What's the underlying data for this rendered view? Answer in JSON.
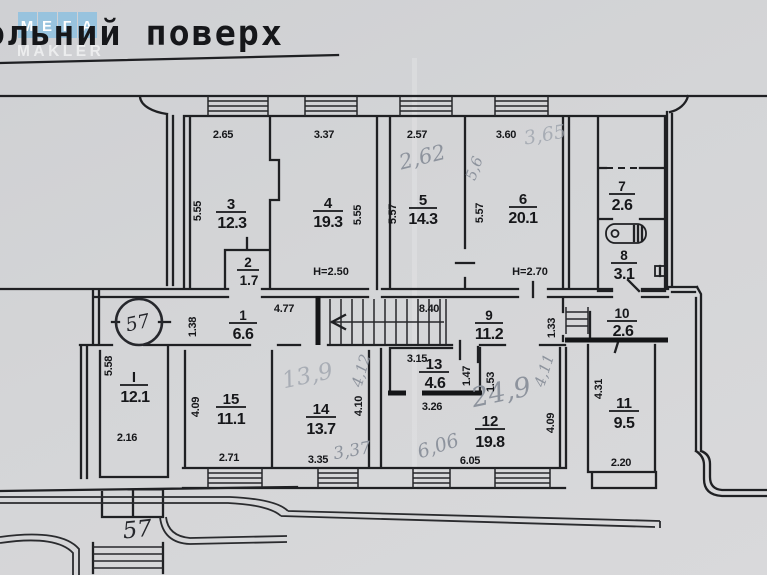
{
  "page": {
    "title": "ольний поверх",
    "watermark": {
      "tiles": [
        "М",
        "Е",
        "Г",
        "А"
      ],
      "subtitle": "MAKLER"
    }
  },
  "plan": {
    "apartment_number": "57",
    "entrance_label": "57",
    "rooms": [
      {
        "number": "1",
        "area": "6.6"
      },
      {
        "number": "2",
        "area": "1.7"
      },
      {
        "number": "3",
        "area": "12.3"
      },
      {
        "number": "4",
        "area": "19.3"
      },
      {
        "number": "5",
        "area": "14.3"
      },
      {
        "number": "6",
        "area": "20.1"
      },
      {
        "number": "7",
        "area": "2.6"
      },
      {
        "number": "8",
        "area": "3.1"
      },
      {
        "number": "9",
        "area": "11.2"
      },
      {
        "number": "10",
        "area": "2.6"
      },
      {
        "number": "11",
        "area": "9.5"
      },
      {
        "number": "12",
        "area": "19.8"
      },
      {
        "number": "13",
        "area": "4.6"
      },
      {
        "number": "14",
        "area": "13.7"
      },
      {
        "number": "15",
        "area": "11.1"
      },
      {
        "number": "I",
        "area": "12.1"
      }
    ],
    "heights": {
      "room4": "H=2.50",
      "room6": "H=2.70"
    },
    "dims": {
      "r3_top": "2.65",
      "r3_side": "5.55",
      "r4_top": "3.37",
      "r4_side": "5.55",
      "r5_top": "2.57",
      "r5_side": "5.57",
      "r6_top": "3.60",
      "r6_side": "5.57",
      "r1_top": "4.77",
      "r1_side": "1.38",
      "r9_top": "8.40",
      "r9_side": "1.33",
      "r13_top": "3.15",
      "r13_side": "1.47",
      "r12_niche": "1.53",
      "r12_top": "3.26",
      "r12_side": "4.09",
      "r12_bottom": "6.05",
      "r14_side": "4.10",
      "r14_bottom": "3.35",
      "r15_side": "4.09",
      "r15_bottom": "2.71",
      "rI_side": "5.58",
      "rI_bottom": "2.16",
      "r11_side": "4.31",
      "r11_bottom": "2.20"
    },
    "handwritten": {
      "r5_top": "2,62",
      "r5_divider": "5,6",
      "r6_top": "3,65",
      "r14_area": "13,9",
      "r14_side": "4,12",
      "r14_bottom": "3,37",
      "r12_area": "24,9",
      "r12_side": "4,11",
      "r12_bottom": "6,06"
    }
  }
}
